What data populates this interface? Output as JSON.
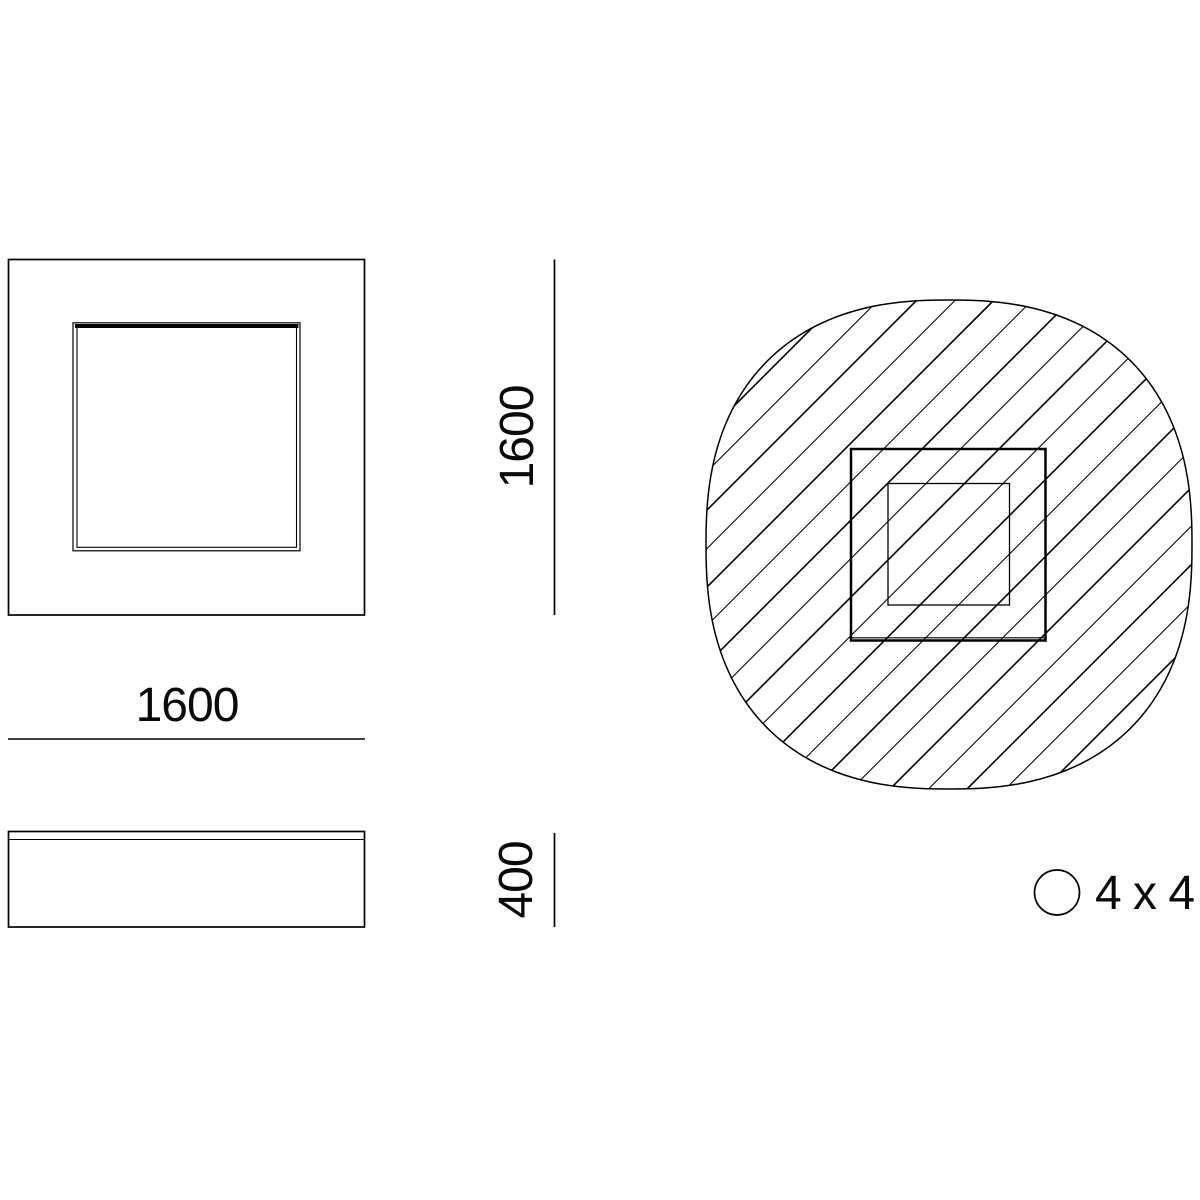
{
  "drawing": {
    "dimensions": {
      "plan_width": "1600",
      "plan_height": "1600",
      "side_height": "400"
    },
    "legend": {
      "symbol": "circle-icon",
      "label": "4 x 4"
    },
    "colors": {
      "line": "#000000",
      "hatch_primary": "#161616",
      "hatch_secondary": "#6b6b6b"
    }
  }
}
